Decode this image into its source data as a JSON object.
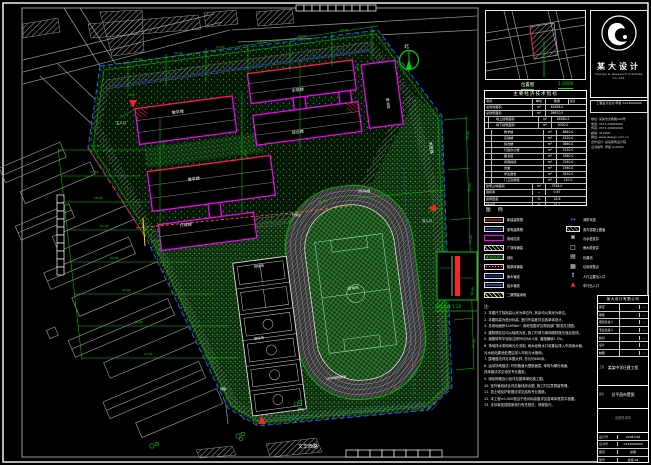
{
  "location_map": {
    "caption": "位置图",
    "scale": "1:2000"
  },
  "logo": {
    "cn_name": "某大设计",
    "en_name": "Design & Research Institute Co.,Ltd.",
    "cert_line": "工程设计证书 甲级 A133000000",
    "info_lines": [
      "地址: 某某市文教路100号",
      "电话: 0571-00000000",
      "传真: 0571-00000000",
      "邮编: 310000",
      "网址: www.design.com.cn",
      "合作设计: 某某建筑设计院",
      "证书编号: 甲级 A10000"
    ]
  },
  "indicator_table": {
    "title": "主要经济技术指标",
    "headers": [
      "项目",
      "单位",
      "数量",
      "备注"
    ],
    "rows": [
      {
        "label": "总用地面积",
        "unit": "m²",
        "qty": "42658.0",
        "note": "",
        "lv": 0
      },
      {
        "label": "总建筑面积",
        "unit": "m²",
        "qty": "28670.5",
        "note": "",
        "lv": 0
      },
      {
        "label": "地上建筑面积",
        "unit": "m²",
        "qty": "26580.5",
        "note": "",
        "lv": 1
      },
      {
        "label": "地下建筑面积",
        "unit": "m²",
        "qty": "2090.0",
        "note": "",
        "lv": 1
      },
      {
        "label": "教学楼",
        "unit": "m²",
        "qty": "8640.0",
        "note": "",
        "lv": 2
      },
      {
        "label": "实验楼",
        "unit": "m²",
        "qty": "4320.0",
        "note": "",
        "lv": 2
      },
      {
        "label": "综合楼",
        "unit": "m²",
        "qty": "3860.0",
        "note": "",
        "lv": 2
      },
      {
        "label": "行政办公楼",
        "unit": "m²",
        "qty": "2150.0",
        "note": "",
        "lv": 2
      },
      {
        "label": "图书馆",
        "unit": "m²",
        "qty": "1860.0",
        "note": "",
        "lv": 2
      },
      {
        "label": "风雨操场",
        "unit": "m²",
        "qty": "2240.0",
        "note": "",
        "lv": 2
      },
      {
        "label": "食堂",
        "unit": "m²",
        "qty": "1980.0",
        "note": "",
        "lv": 2
      },
      {
        "label": "学生宿舍",
        "unit": "m²",
        "qty": "3450.0",
        "note": "",
        "lv": 2
      },
      {
        "label": "门卫及附属",
        "unit": "m²",
        "qty": "120.0",
        "note": "",
        "lv": 2
      },
      {
        "label": "建筑占地面积",
        "unit": "m²",
        "qty": "7934.0",
        "note": "",
        "lv": 0
      },
      {
        "label": "容积率",
        "unit": "—",
        "qty": "0.67",
        "note": "",
        "lv": 0
      },
      {
        "label": "建筑密度",
        "unit": "%",
        "qty": "18.6",
        "note": "",
        "lv": 0
      },
      {
        "label": "绿地率",
        "unit": "%",
        "qty": "35.2",
        "note": "",
        "lv": 0
      },
      {
        "label": "机动车停车位",
        "unit": "辆",
        "qty": "45",
        "note": "其中地下30辆",
        "lv": 0
      },
      {
        "label": "非机动车停车位",
        "unit": "辆",
        "qty": "600",
        "note": "",
        "lv": 0
      },
      {
        "label": "办学规模",
        "unit": "班",
        "qty": "36",
        "note": "在校生1800人",
        "lv": 0
      }
    ]
  },
  "legend": {
    "title": "图 例",
    "left": [
      {
        "k": "new-building",
        "label": "新建建筑物"
      },
      {
        "k": "existing-building",
        "label": "原有建筑物"
      },
      {
        "k": "red-line",
        "label": "用地红线"
      },
      {
        "k": "paving",
        "label": "广场砖铺装"
      },
      {
        "k": "green",
        "label": "绿化"
      },
      {
        "k": "grass-paving",
        "label": "植草砖铺装"
      },
      {
        "k": "rain-pipe",
        "label": "雨水管线"
      },
      {
        "k": "water-pipe",
        "label": "给水管线"
      },
      {
        "k": "phase2",
        "label": "二期预留用地"
      }
    ],
    "right": [
      {
        "k": "fire-lane",
        "label": "消防车道",
        "glyph": "↔",
        "gc": "#4d7dff"
      },
      {
        "k": "asphalt",
        "label": "沥青混凝土路面"
      },
      {
        "k": "sewage-well",
        "label": "污水检查井",
        "glyph": "⊗",
        "gc": "#ffffff"
      },
      {
        "k": "rain-well",
        "label": "雨水检查井",
        "glyph": "□",
        "gc": "#ffffff"
      },
      {
        "k": "septic",
        "label": "化粪池",
        "glyph": "▤",
        "gc": "#dddddd"
      },
      {
        "k": "trash",
        "label": "垃圾收集点",
        "glyph": "▦",
        "gc": "#dddddd"
      },
      {
        "k": "entry-people",
        "label": "人行主要出入口",
        "glyph": "⇧",
        "gc": "#ffffff"
      },
      {
        "k": "entry-car",
        "label": "车行出入口",
        "glyph": "▲",
        "gc": "#ff2a2a"
      }
    ]
  },
  "notes": {
    "title": "注:",
    "lines": [
      "1. 本图尺寸除标高以米为单位外, 其余均以毫米为单位。",
      "2. 本图标高为绝对标高, 室内外高差详见各单体设计。",
      "3. 总用地面积42658m², 用地范围详见规划部门核发红线图。",
      "4. 建筑物定位均以轴线为准, 施工时请与单体图校核无误后放线。",
      "5. 道路转弯半径除注明外均为6.0米, 道路横坡1.5%。",
      "6. 场地排水采用雨污分流制, 雨水经雨水口收集后排入市政雨水管,",
      "   污水经化粪池处理后排入市政污水管网。",
      "7. 围墙做法详见本图大样, 总长约680米。",
      "8. 运动场地做法: 环形跑道为塑胶面层, 球场为硬化地面,",
      "   具体做法详见相关专业图纸。",
      "9. 绿化种植及小品详见园林绿化施工图。",
      "10. 室外管线综合详见管线综合图, 施工时注意预留预埋。",
      "11. 挡土墙及护坡做法详见结构专业图纸。",
      "12. 本工程±0.000相当于绝对标高值详见各单体首层平面图。",
      "13. 未尽事宜按国家现行有关规范、规程执行。"
    ]
  },
  "titleblock": {
    "header": "某大设计有限公司",
    "sign_rows": [
      {
        "label": "审定",
        "mark": "—"
      },
      {
        "label": "审核",
        "mark": "—"
      },
      {
        "label": "项目负责人",
        "mark": "—"
      },
      {
        "label": "专业负责人",
        "mark": "—"
      },
      {
        "label": "校对",
        "mark": "—"
      },
      {
        "label": "设计",
        "mark": "—"
      },
      {
        "label": "制图",
        "mark": "—"
      }
    ],
    "project_label": "工程",
    "project_name": "某某中学迁建工程",
    "drawing_label": "图名",
    "drawing_name": "总平面布置图",
    "stamp": "出图专用章",
    "bottom_rows": [
      {
        "label": "设计号",
        "value": "2008-036"
      },
      {
        "label": "证书号",
        "value": "A133000000"
      },
      {
        "label": "图别",
        "value": "总施"
      },
      {
        "label": "图号",
        "value": "总施-01"
      },
      {
        "label": "日期",
        "value": "2008.06"
      },
      {
        "label": "比例",
        "value": "1:500"
      }
    ]
  },
  "drawing": {
    "labels": [
      {
        "t": "北",
        "x": 404,
        "y": 48,
        "s": 5
      },
      {
        "t": "教学楼",
        "x": 172,
        "y": 114,
        "s": 4,
        "r": -7
      },
      {
        "t": "实验楼",
        "x": 292,
        "y": 92,
        "s": 4,
        "r": -7
      },
      {
        "t": "综合楼",
        "x": 292,
        "y": 134,
        "s": 4,
        "r": -7
      },
      {
        "t": "教学楼",
        "x": 188,
        "y": 181,
        "s": 4,
        "r": -7
      },
      {
        "t": "行政楼",
        "x": 180,
        "y": 227,
        "s": 4,
        "r": -7
      },
      {
        "t": "图书馆",
        "x": 386,
        "y": 98,
        "s": 3.6,
        "r": 83
      },
      {
        "t": "排球场",
        "x": 254,
        "y": 268,
        "s": 3.4,
        "r": -7
      },
      {
        "t": "篮球场",
        "x": 254,
        "y": 340,
        "s": 3.4,
        "r": -7
      },
      {
        "t": "足球场",
        "x": 348,
        "y": 290,
        "s": 3.6,
        "r": -7
      },
      {
        "t": "200M塑胶跑道",
        "x": 326,
        "y": 380,
        "s": 3,
        "r": -7
      },
      {
        "t": "升旗台",
        "x": 292,
        "y": 216,
        "s": 3
      },
      {
        "t": "主入口",
        "x": 116,
        "y": 124,
        "s": 3.4
      },
      {
        "t": "次入口",
        "x": 422,
        "y": 222,
        "s": 3.4
      },
      {
        "t": "自行车棚",
        "x": 358,
        "y": 192,
        "s": 3
      },
      {
        "t": "围墙",
        "x": 220,
        "y": 390,
        "s": 3
      },
      {
        "t": "文华西路",
        "x": 298,
        "y": 448,
        "s": 5
      },
      {
        "t": "求是路",
        "x": 429,
        "y": 142,
        "s": 4,
        "r": 83
      },
      {
        "t": "J7",
        "x": 412,
        "y": 366,
        "s": 3.6,
        "c": "#ff4040"
      },
      {
        "t": "J8",
        "x": 394,
        "y": 390,
        "s": 3.6,
        "c": "#ff4040"
      },
      {
        "t": "围墙大样 1:20",
        "x": 435,
        "y": 308,
        "s": 4,
        "c": "#00dc00"
      },
      {
        "t": "绿化",
        "x": 298,
        "y": 410,
        "s": 3,
        "c": "#9fef9f"
      }
    ],
    "dims": [
      {
        "t": "15.00",
        "x": 92,
        "y": 147
      },
      {
        "t": "12.50",
        "x": 90,
        "y": 173
      },
      {
        "t": "18.00",
        "x": 94,
        "y": 199
      },
      {
        "t": "21.00",
        "x": 100,
        "y": 227
      },
      {
        "t": "24.00",
        "x": 110,
        "y": 259
      },
      {
        "t": "30.00",
        "x": 122,
        "y": 291
      },
      {
        "t": "36.00",
        "x": 134,
        "y": 323
      },
      {
        "t": "27.00",
        "x": 144,
        "y": 355
      },
      {
        "t": "15.00",
        "x": 134,
        "y": 60
      },
      {
        "t": "21.00",
        "x": 174,
        "y": 54
      },
      {
        "t": "24.00",
        "x": 216,
        "y": 48
      },
      {
        "t": "18.00",
        "x": 258,
        "y": 43
      },
      {
        "t": "30.00",
        "x": 298,
        "y": 37
      },
      {
        "t": "15.00",
        "x": 340,
        "y": 31
      },
      {
        "t": "30.00",
        "x": 468,
        "y": 140,
        "r": -83
      },
      {
        "t": "30.00",
        "x": 470,
        "y": 192,
        "r": -83
      },
      {
        "t": "24.00",
        "x": 471,
        "y": 244,
        "r": -83
      },
      {
        "t": "30.00",
        "x": 473,
        "y": 296,
        "r": -83
      },
      {
        "t": "27.00",
        "x": 474,
        "y": 348,
        "r": -83
      },
      {
        "t": "7.50",
        "x": 162,
        "y": 140,
        "r": 83
      },
      {
        "t": "6.00",
        "x": 244,
        "y": 150,
        "r": 83
      },
      {
        "t": "59.40",
        "x": 318,
        "y": 203,
        "r": -7
      },
      {
        "t": "4.50",
        "x": 128,
        "y": 96
      },
      {
        "t": "9.00",
        "x": 356,
        "y": 64,
        "r": 83
      }
    ]
  }
}
